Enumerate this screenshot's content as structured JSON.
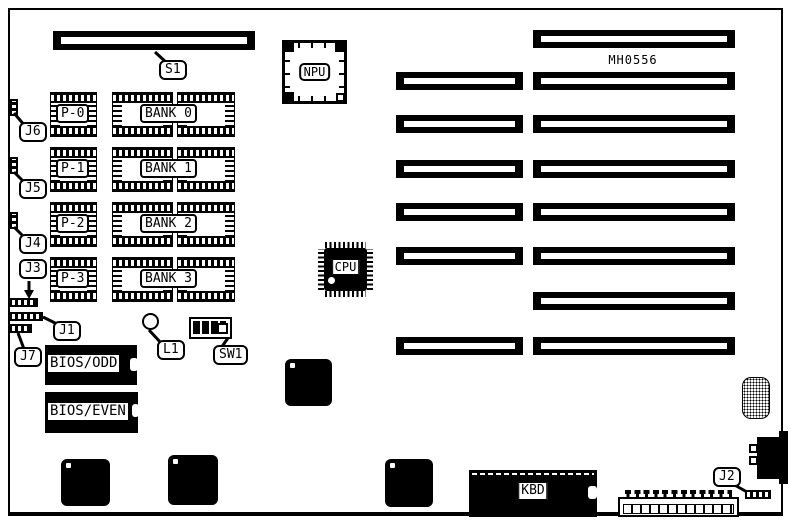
{
  "board": {
    "id_label": "MH0556"
  },
  "labels": {
    "s1": "S1",
    "npu": "NPU",
    "cpu": "CPU",
    "kbd": "KBD",
    "l1": "L1",
    "sw1": "SW1",
    "j1": "J1",
    "j2": "J2",
    "j3": "J3",
    "j4": "J4",
    "j5": "J5",
    "j6": "J6",
    "j7": "J7",
    "bios_odd": "BIOS/ODD",
    "bios_even": "BIOS/EVEN"
  },
  "memory": {
    "parity": [
      "P-0",
      "P-1",
      "P-2",
      "P-3"
    ],
    "banks": [
      "BANK 0",
      "BANK 1",
      "BANK 2",
      "BANK 3"
    ]
  }
}
